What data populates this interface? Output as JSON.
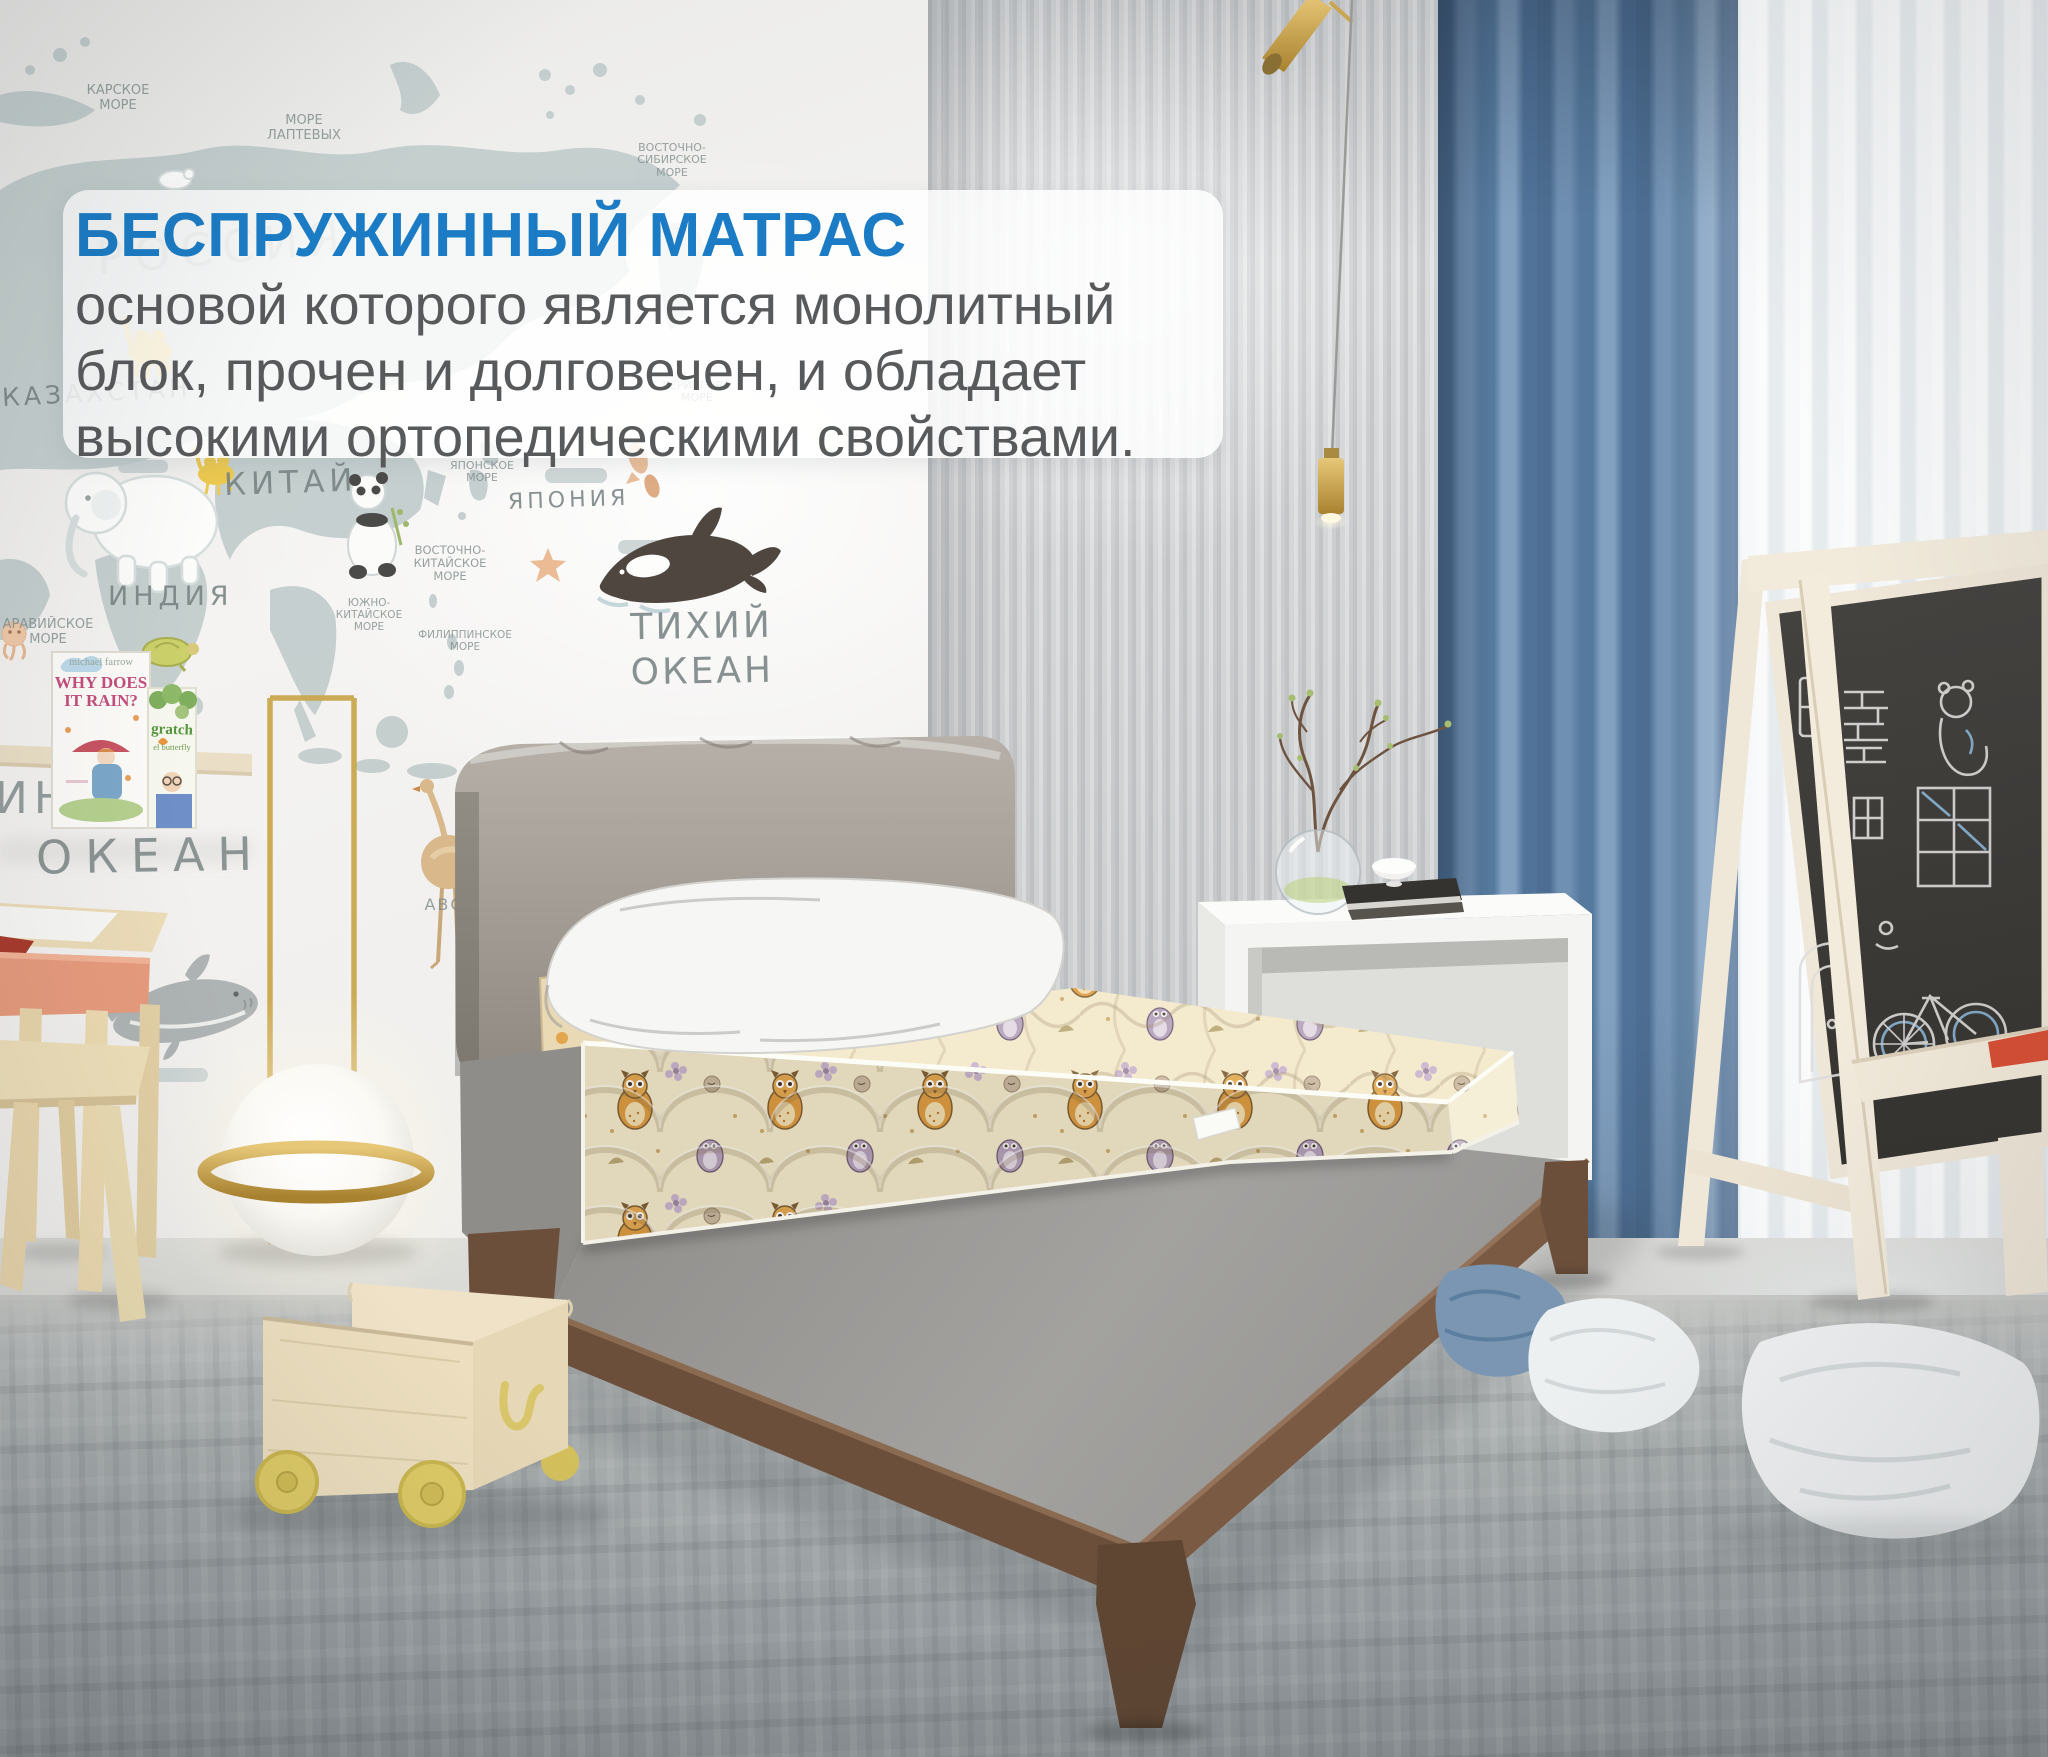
{
  "overlay": {
    "title": "БЕСПРУЖИННЫЙ МАТРАС",
    "line1": "основой которого является монолитный",
    "line2": "блок, прочен и долговечен, и обладает",
    "line3": "высокими ортопедическими свойствами.",
    "title_color": "#1b7cc5",
    "body_color": "#58595b",
    "panel_background": "rgba(255,255,255,0.84)"
  },
  "wall_map": {
    "labels": [
      {
        "id": "kara-sea",
        "text": "КАРСКОЕ\nМОРЕ"
      },
      {
        "id": "laptev-sea",
        "text": "МОРЕ\nЛАПТЕВЫХ"
      },
      {
        "id": "east-siberian-sea",
        "text": "ВОСТОЧНО-\nСИБИРСКОЕ\nМОРЕ"
      },
      {
        "id": "russia",
        "text": "РОССИЯ"
      },
      {
        "id": "kazakhstan",
        "text": "КАЗАХСТАН"
      },
      {
        "id": "china",
        "text": "КИТАЙ"
      },
      {
        "id": "india",
        "text": "ИНДИЯ"
      },
      {
        "id": "arabian-sea",
        "text": "АРАВИЙСКОЕ\nМОРЕ"
      },
      {
        "id": "bering-sea",
        "text": "БЕРИНГОВО\nМОРЕ"
      },
      {
        "id": "japan-sea",
        "text": "ЯПОНСКОЕ\nМОРЕ"
      },
      {
        "id": "japan",
        "text": "ЯПОНИЯ"
      },
      {
        "id": "east-china-sea",
        "text": "ВОСТОЧНО-\nКИТАЙСКОЕ\nМОРЕ"
      },
      {
        "id": "south-china-sea",
        "text": "ЮЖНО-\nКИТАЙСКОЕ\nМОРЕ"
      },
      {
        "id": "philippine-sea",
        "text": "ФИЛИППИНСКОЕ\nМОРЕ"
      },
      {
        "id": "pacific-ocean",
        "text": "ТИХИЙ\nОКЕАН"
      },
      {
        "id": "indian-ocean-part1",
        "text": "ИНД"
      },
      {
        "id": "indian-ocean-part2",
        "text": "ОКЕАН"
      },
      {
        "id": "abc",
        "text": "АВС"
      }
    ]
  },
  "bookshelf": {
    "book1_author": "michael farrow",
    "book1_title": "WHY DOES\nIT RAIN?",
    "book2_title": "gratch",
    "book2_subtitle": "el butterfly"
  },
  "colors": {
    "accent_blue": "#1b7cc5",
    "body_text": "#58595b",
    "curtain_blue": "#5e80a5",
    "mattress_cream": "#f2e8ca",
    "owl_orange": "#dd9a3f",
    "bed_wood": "#6b4f3b",
    "headboard_gray": "#a49e96",
    "lamp_brass": "#c8a64f",
    "chalkboard": "#3e3c39",
    "floor_gray": "#9aa0a3"
  }
}
